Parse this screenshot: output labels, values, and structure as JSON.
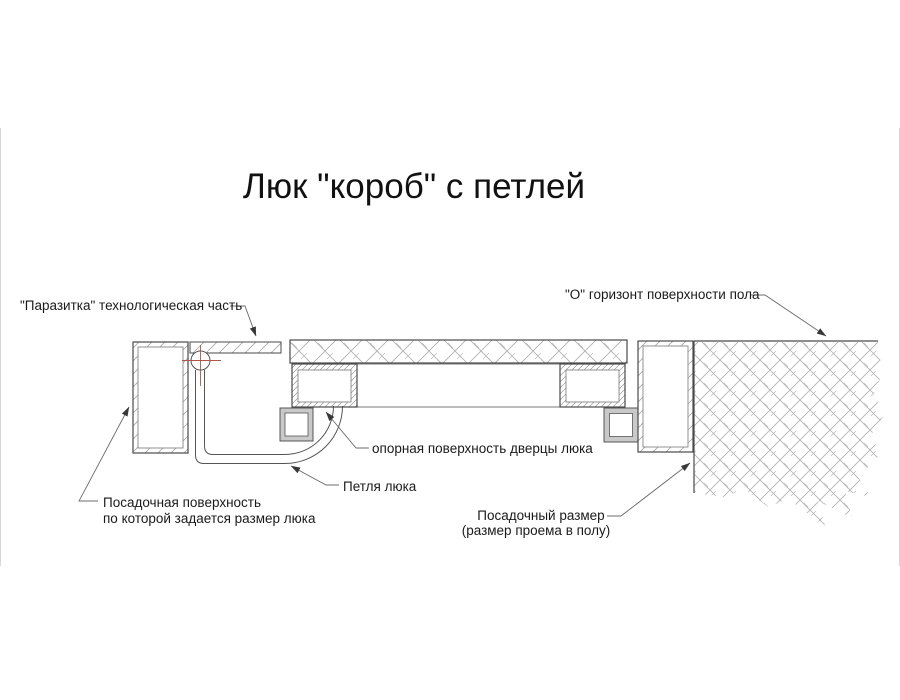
{
  "title": "Люк \"короб\" с петлей",
  "diagram": {
    "type": "technical-section-drawing",
    "subject": "floor hatch box with hinge, cross-section",
    "labels": {
      "parasitka": "\"Паразитка\" технологическая часть",
      "horizon": "\"О\" горизонт поверхности пола",
      "support_surface": "опорная поверхность дверцы люка",
      "hinge": "Петля люка",
      "seating_surface": [
        "Посадочная поверхность",
        "по которой задается размер люка"
      ],
      "seating_size": [
        "Посадочный размер",
        "(размер проема в полу)"
      ]
    },
    "colors": {
      "background": "#ffffff",
      "outline": "#4a4a4a",
      "leader": "#6b6b6b",
      "hatch": "#ababab",
      "centerline": "#b0554b",
      "foot_fill": "#c9c9c9",
      "text": "#1a1a1a"
    }
  }
}
